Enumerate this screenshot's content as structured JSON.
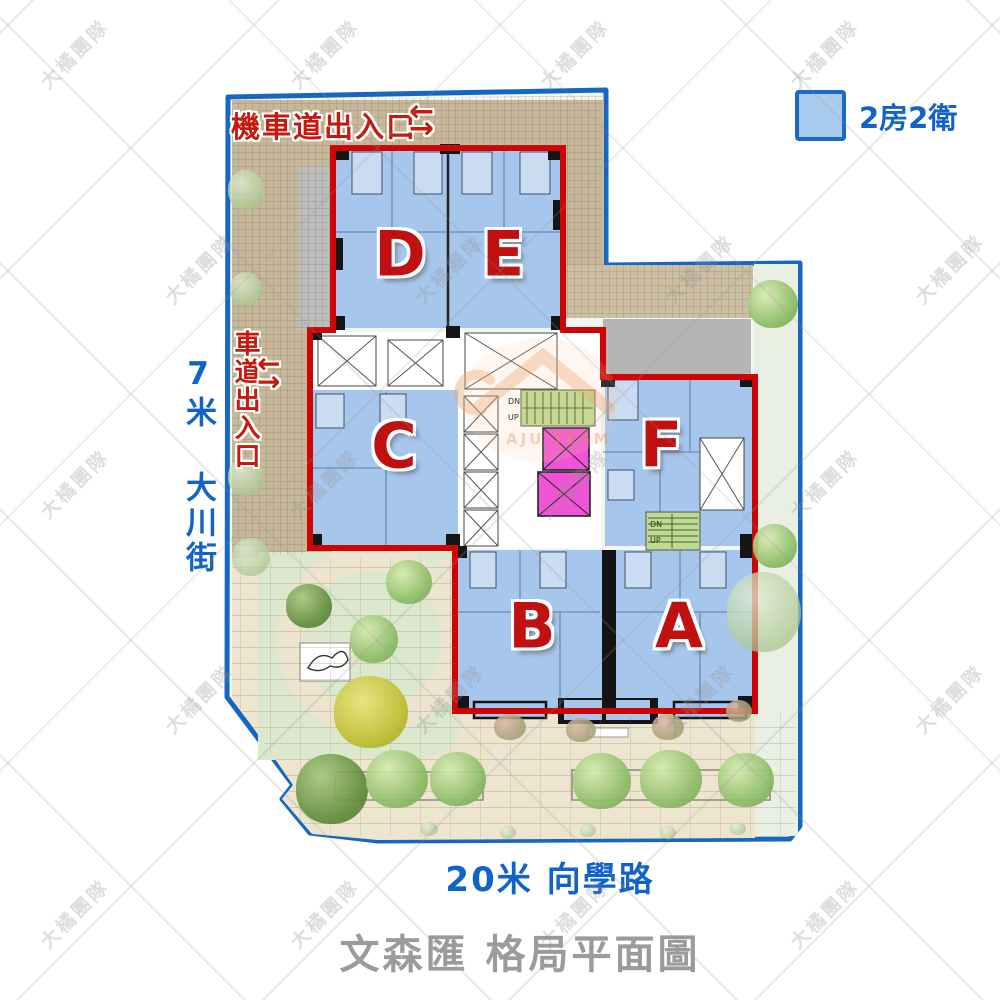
{
  "title": "文森匯 格局平面圖",
  "legend": {
    "label": "2房2衛"
  },
  "entrances": {
    "moto_label": "機車道出入口",
    "car_label": "車道出入口",
    "arrow_left": "←",
    "arrow_right": "→"
  },
  "streets": {
    "left_label": "7米 大川街",
    "bottom_label": "20米 向學路"
  },
  "units": [
    {
      "label": "D"
    },
    {
      "label": "E"
    },
    {
      "label": "C"
    },
    {
      "label": "F"
    },
    {
      "label": "B"
    },
    {
      "label": "A"
    }
  ],
  "stairs": {
    "up": "UP",
    "dn": "DN"
  },
  "watermark": {
    "text": "大橘團隊",
    "logo_text": "AJU TEAM"
  },
  "colors": {
    "unit_fill": "#a6c6ec",
    "building_outline": "#cf0505",
    "site_boundary": "#1766c2",
    "street_text": "#1263c8",
    "entrance_text": "#c41a10",
    "unit_letter": "#c01010",
    "title_text": "#9b9b9b",
    "elevator": "#f153d6",
    "stairs_fill": "#bedc90"
  }
}
